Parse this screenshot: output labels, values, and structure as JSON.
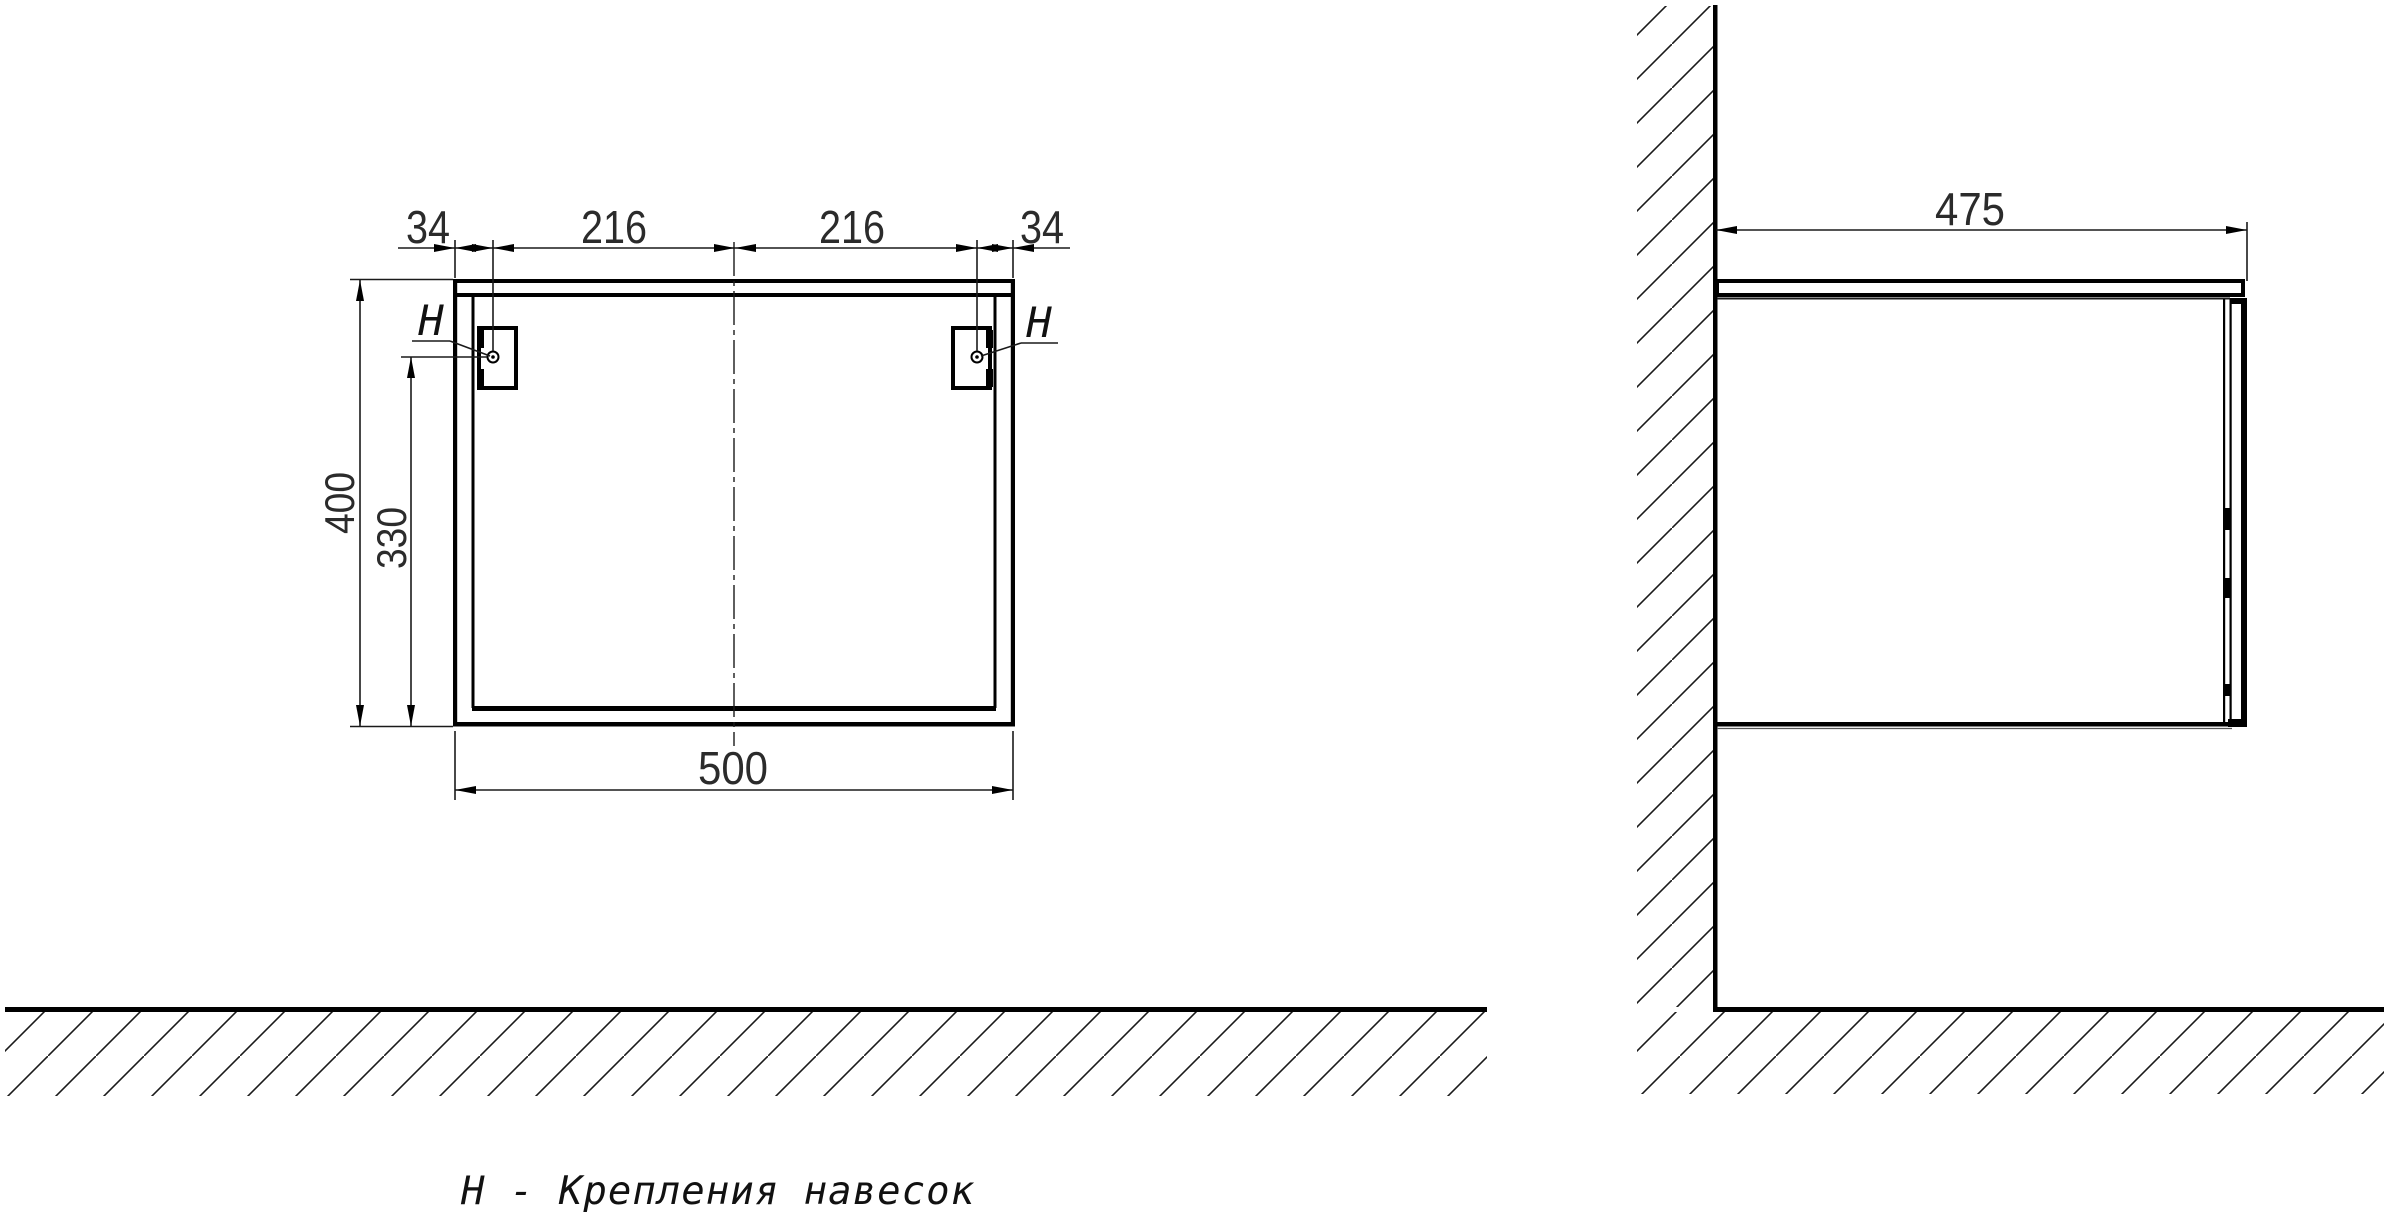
{
  "drawing": {
    "type": "furniture-mounting-diagram",
    "caption": "Н - Крепления навесок",
    "colors": {
      "line": "#000000",
      "text": "#1a1a1a",
      "background": "#ffffff"
    },
    "front_view": {
      "top_dims": {
        "left_offset": "34",
        "left_span": "216",
        "right_span": "216",
        "right_offset": "34"
      },
      "height_dim": "400",
      "hole_height_dim": "330",
      "width_dim": "500",
      "fastener_label_left": "Н",
      "fastener_label_right": "Н"
    },
    "side_view": {
      "depth_dim": "475"
    },
    "dimensions_mm": {
      "cabinet_width": 500,
      "cabinet_height": 400,
      "cabinet_depth": 475,
      "bracket_hole_side_offset": 34,
      "bracket_hole_to_center": 216,
      "bracket_hole_above_bottom": 330
    }
  }
}
